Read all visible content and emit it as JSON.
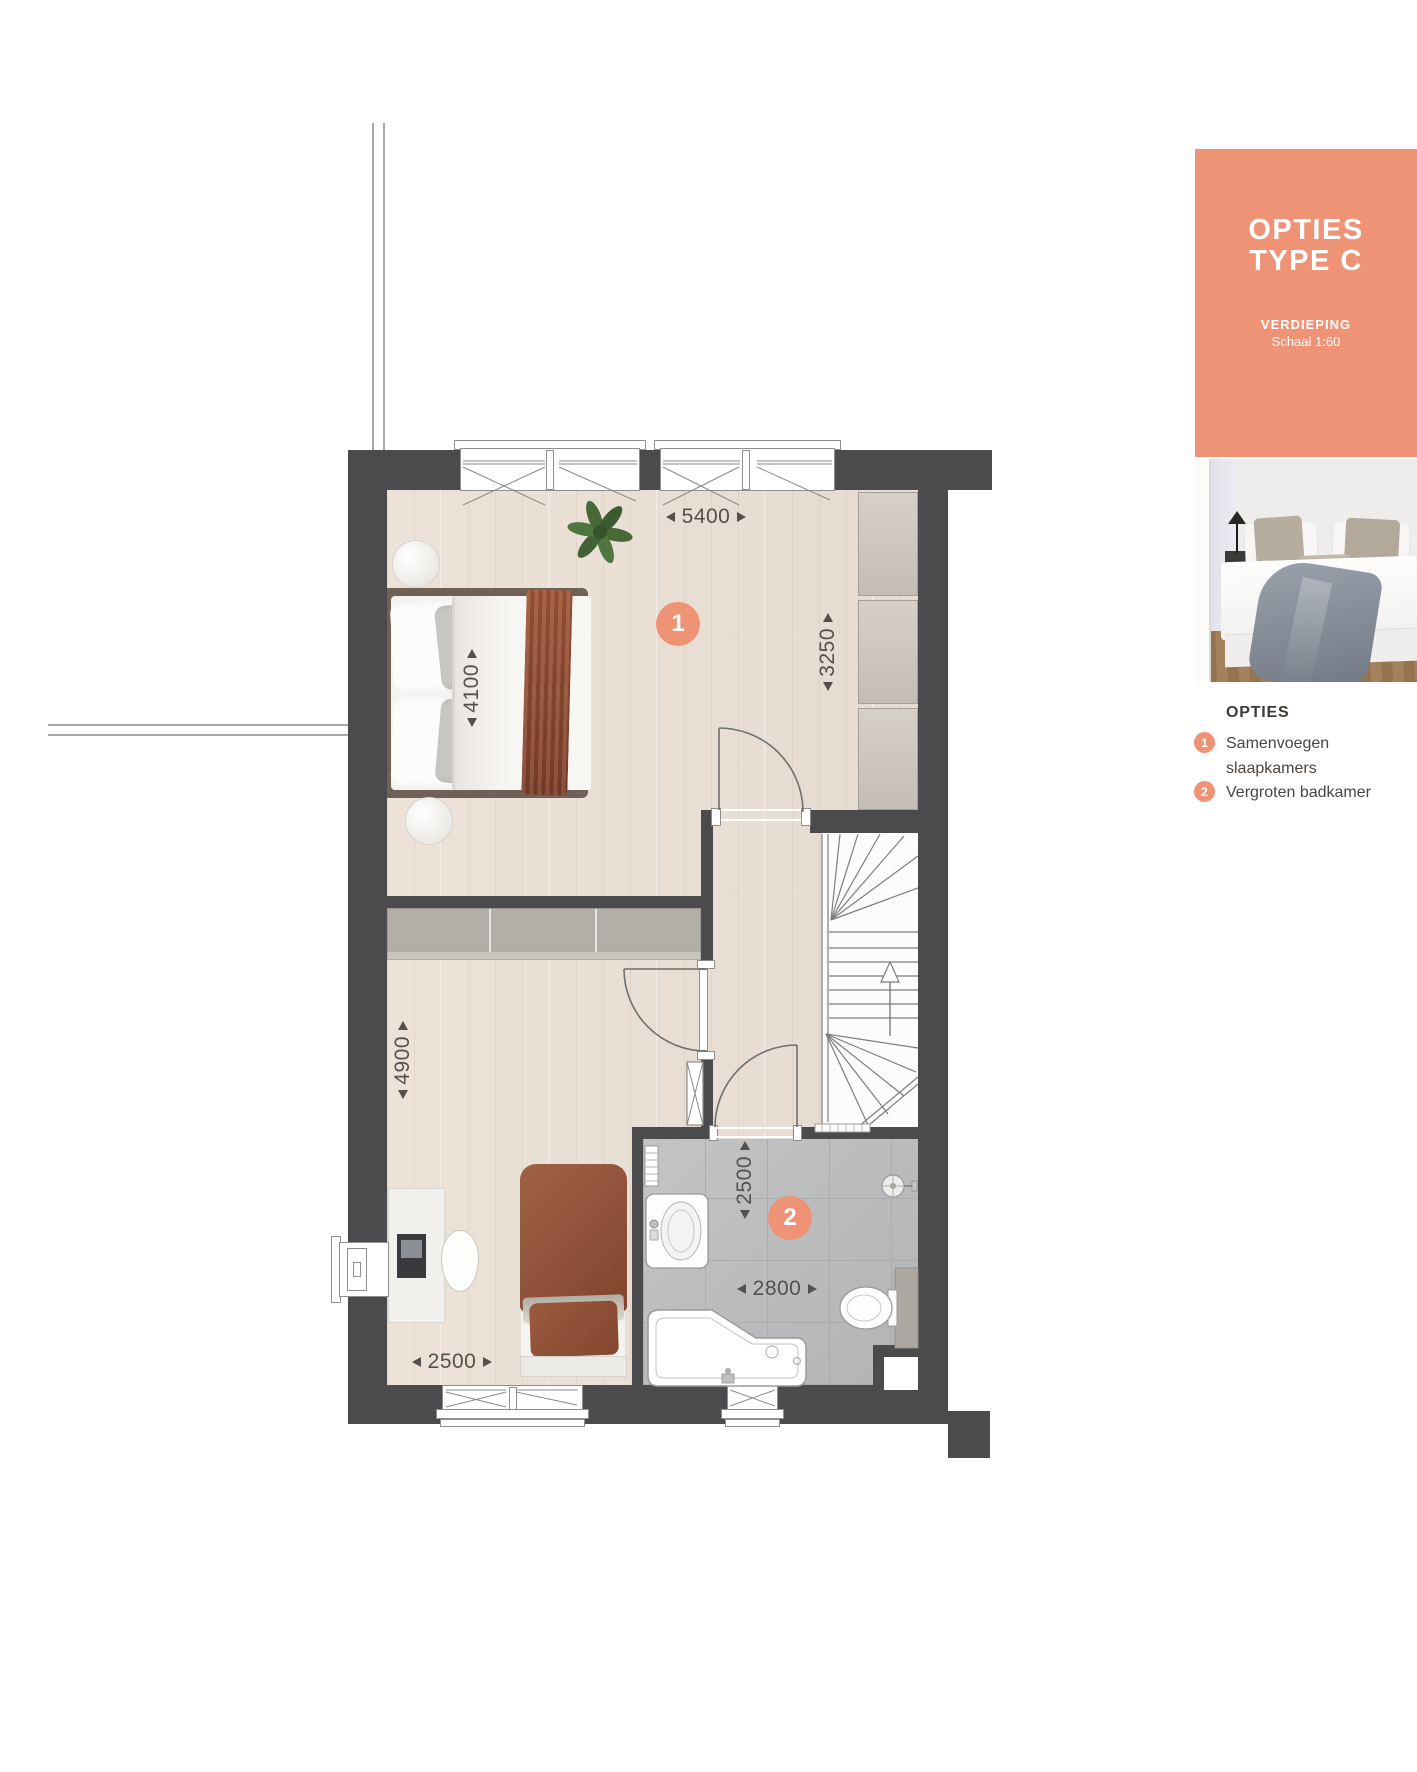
{
  "panel": {
    "title_line1": "OPTIES",
    "title_line2": "TYPE C",
    "subtitle": "VERDIEPING",
    "scale": "Schaal 1:60"
  },
  "legend": {
    "header": "OPTIES",
    "items": [
      {
        "number": "1",
        "label": "Samenvoegen slaapkamers"
      },
      {
        "number": "2",
        "label": "Vergroten badkamer"
      }
    ]
  },
  "plan_markers": {
    "marker1": {
      "number": "1"
    },
    "marker2": {
      "number": "2"
    }
  },
  "dimensions": {
    "bedroom1_width": {
      "value": "5400",
      "orientation": "horizontal"
    },
    "closet_depth": {
      "value": "3250",
      "orientation": "vertical"
    },
    "bed_length": {
      "value": "4100",
      "orientation": "vertical"
    },
    "bedroom2_length": {
      "value": "4900",
      "orientation": "vertical"
    },
    "bedroom2_width": {
      "value": "2500",
      "orientation": "horizontal"
    },
    "bathroom_depth": {
      "value": "2500",
      "orientation": "vertical"
    },
    "bathroom_width": {
      "value": "2800",
      "orientation": "horizontal"
    }
  },
  "colors": {
    "accent_coral": "#EF9377",
    "wall_dark": "#4B4B4D",
    "dimension_text": "#55504B",
    "wood_floor": "#EAE0D6",
    "tile_floor": "#BCBDBF"
  },
  "icons": {
    "plan-marker": "circle-badge",
    "stairs-up-arrow": "triangle-up",
    "dimension-arrows": "solid-triangles"
  }
}
